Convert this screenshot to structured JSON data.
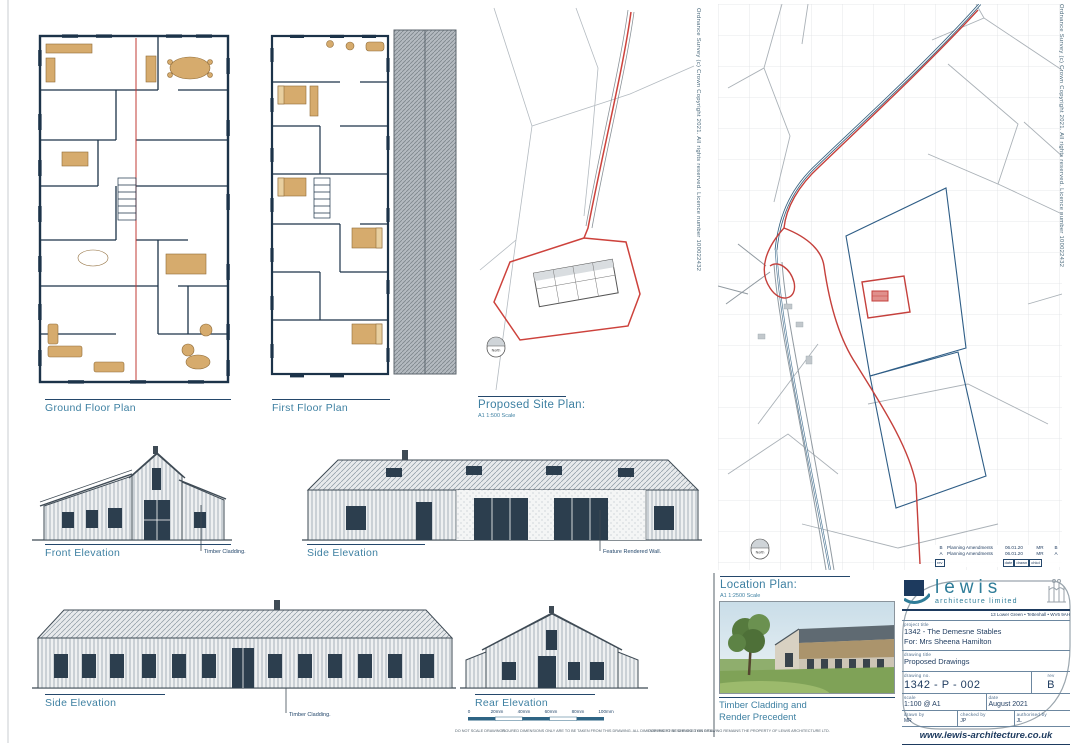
{
  "os_copyright": "Ordnance Survey (c) Crown Copyright 2021.  All rights reserved. Licence number 100022432",
  "labels": {
    "ground_floor_plan": "Ground Floor Plan",
    "first_floor_plan": "First Floor Plan",
    "proposed_site_plan": "Proposed Site Plan:",
    "site_plan_scale": "A1 1:500 Scale",
    "location_plan": "Location Plan:",
    "location_plan_scale": "A1 1:2500 Scale",
    "front_elevation": "Front Elevation",
    "side_elevation_upper": "Side Elevation",
    "side_elevation_lower": "Side Elevation",
    "rear_elevation": "Rear Elevation",
    "north": "North",
    "precedent_line1": "Timber Cladding and",
    "precedent_line2": "Render Precedent"
  },
  "annotations": {
    "front_cladding_note": "Timber Cladding.",
    "feature_render_note": "Feature Rendered Wall.",
    "lower_cladding_note": "Timber Cladding."
  },
  "scale_bar": {
    "ticks": [
      "0",
      "20mm",
      "40mm",
      "60mm",
      "80mm",
      "100mm"
    ]
  },
  "footer_notes": [
    "DO NOT SCALE DRAWINGS.",
    "FIGURED DIMENSIONS ONLY ARE TO BE TAKEN FROM THIS DRAWING. ALL DIMENSIONS TO BE CHECKED ON SITE.",
    "COPYRIGHT RESERVED. THIS DRAWING REMAINS THE PROPERTY OF LEWIS ARCHITECTURE LTD."
  ],
  "revisions": {
    "rows": [
      {
        "rev": "B",
        "desc": "Planning Amendments",
        "date": "06.01.20",
        "by": "MR",
        "chk": "B"
      },
      {
        "rev": "A",
        "desc": "Planning Amendments",
        "date": "06.01.20",
        "by": "MR",
        "chk": "A"
      }
    ],
    "headers": {
      "rev": "rev",
      "date": "date",
      "drawn": "drawn",
      "chkd": "chkd"
    }
  },
  "title_block": {
    "logo_name": "lewis",
    "logo_subtitle": "architecture limited",
    "address": "13 Lower Green • Tettenhall • WV6 9AH",
    "project_title_label": "project title",
    "project_title": "1342 - The Demesne Stables",
    "project_for": "For: Mrs Sheena Hamilton",
    "drawing_title_label": "drawing title",
    "drawing_title": "Proposed Drawings",
    "drawing_no_label": "drawing no.",
    "drawing_no": "1342 - P - 002",
    "rev_label": "rev",
    "rev": "B",
    "scale_label": "scale",
    "scale": "1:100  @ A1",
    "date_label": "date",
    "date": "August 2021",
    "drawn_by_label": "drawn by",
    "drawn_by": "MR",
    "checked_by_label": "checked by",
    "checked_by": "JP",
    "authorised_by_label": "authorised by",
    "authorised_by": "JL",
    "website": "www.lewis-architecture.co.uk"
  }
}
